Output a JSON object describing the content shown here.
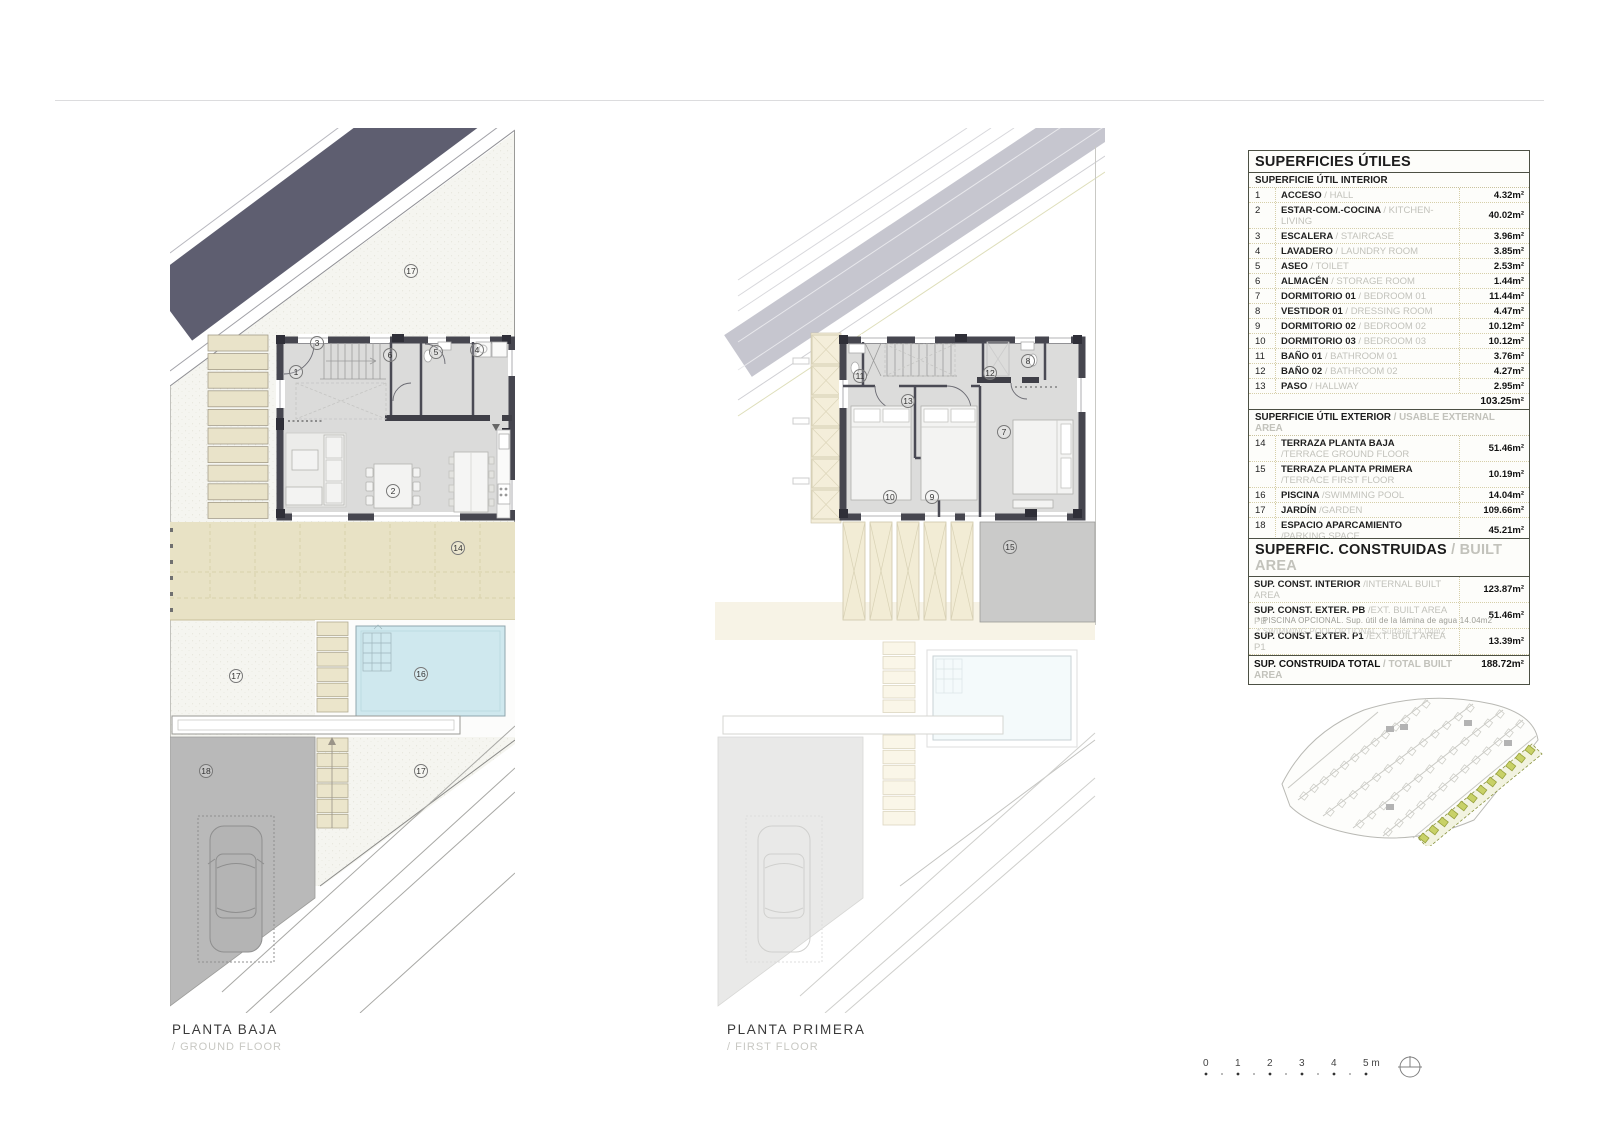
{
  "captions": {
    "floor1": "PLANTA BAJA",
    "floor1_sub": "/ GROUND FLOOR",
    "floor2": "PLANTA PRIMERA",
    "floor2_sub": "/ FIRST FLOOR"
  },
  "tables": {
    "utiles": {
      "title": "SUPERFICIES ÚTILES",
      "interior_header": "SUPERFICIE ÚTIL INTERIOR",
      "interior_rows": [
        {
          "num": "1",
          "es": "ACCESO",
          "en": "/ HALL",
          "val": "4.32m²"
        },
        {
          "num": "2",
          "es": "ESTAR-COM.-COCINA",
          "en": "/ KITCHEN-LIVING",
          "val": "40.02m²"
        },
        {
          "num": "3",
          "es": "ESCALERA",
          "en": "/ STAIRCASE",
          "val": "3.96m²"
        },
        {
          "num": "4",
          "es": "LAVADERO",
          "en": "/ LAUNDRY ROOM",
          "val": "3.85m²"
        },
        {
          "num": "5",
          "es": "ASEO",
          "en": "/ TOILET",
          "val": "2.53m²"
        },
        {
          "num": "6",
          "es": "ALMACÉN",
          "en": "/ STORAGE ROOM",
          "val": "1.44m²"
        },
        {
          "num": "7",
          "es": "DORMITORIO 01",
          "en": "/ BEDROOM 01",
          "val": "11.44m²"
        },
        {
          "num": "8",
          "es": "VESTIDOR 01",
          "en": "/ DRESSING ROOM",
          "val": "4.47m²"
        },
        {
          "num": "9",
          "es": "DORMITORIO 02",
          "en": "/ BEDROOM 02",
          "val": "10.12m²"
        },
        {
          "num": "10",
          "es": "DORMITORIO 03",
          "en": "/ BEDROOM 03",
          "val": "10.12m²"
        },
        {
          "num": "11",
          "es": "BAÑO 01",
          "en": "/ BATHROOM 01",
          "val": "3.76m²"
        },
        {
          "num": "12",
          "es": "BAÑO 02",
          "en": "/ BATHROOM 02",
          "val": "4.27m²"
        },
        {
          "num": "13",
          "es": "PASO",
          "en": "/ HALLWAY",
          "val": "2.95m²"
        }
      ],
      "interior_subtotal": "103.25m²",
      "exterior_header_es": "SUPERFICIE ÚTIL EXTERIOR",
      "exterior_header_en": "/ USABLE EXTERNAL AREA",
      "exterior_rows": [
        {
          "num": "14",
          "es": "TERRAZA PLANTA BAJA",
          "en": "/TERRACE GROUND FLOOR",
          "val": "51.46m²",
          "two": true
        },
        {
          "num": "15",
          "es": "TERRAZA PLANTA PRIMERA",
          "en": "/TERRACE FIRST FLOOR",
          "val": "10.19m²",
          "two": true
        },
        {
          "num": "16",
          "es": "PISCINA",
          "en": "/SWIMMING POOL",
          "val": "14.04m²"
        },
        {
          "num": "17",
          "es": "JARDÍN",
          "en": "/GARDEN",
          "val": "109.66m²"
        },
        {
          "num": "18",
          "es": "ESPACIO APARCAMIENTO",
          "en": "/PARKING SPACE",
          "val": "45.21m²",
          "two": true
        }
      ],
      "exterior_subtotal": "230.56m²",
      "total_es": "SUPERFICIE ÚTIL TOTAL",
      "total_en": "/ TOTAL USABLE AREA",
      "total_val": "333.81m²"
    },
    "construidas": {
      "title_es": "SUPERFIC. CONSTRUIDAS",
      "title_en": "/ BUILT AREA",
      "rows": [
        {
          "es": "SUP. CONST. INTERIOR",
          "en": "/INTERNAL BUILT AREA",
          "val": "123.87m²"
        },
        {
          "es": "SUP. CONST. EXTER. PB",
          "en": "/EXT. BUILT AREA PB",
          "val": "51.46m²"
        },
        {
          "es": "SUP. CONST. EXTER. P1",
          "en": "/EXT. BUILT AREA P1",
          "val": "13.39m²"
        }
      ],
      "total_es": "SUP. CONSTRUIDA TOTAL",
      "total_en": "/ TOTAL BUILT AREA",
      "total_val": "188.72m²",
      "footnote_es": "* PISCINA OPCIONAL. Sup. útil de la lámina de agua 14.04m2",
      "footnote_en": "* SWIMMING POOL OPTIONAL. Surface 14.04m2"
    }
  },
  "plans": {
    "ground": {
      "labels": {
        "r1": "1",
        "r2": "2",
        "r3": "3",
        "r4": "4",
        "r5": "5",
        "r6": "6",
        "g17top": "17",
        "t14": "14",
        "g17mid": "17",
        "p16": "16",
        "s18": "18",
        "g17bot": "17"
      }
    },
    "first": {
      "labels": {
        "r7": "7",
        "r8": "8",
        "r9": "9",
        "r10": "10",
        "r11": "11",
        "r12": "12",
        "r13": "13",
        "t15": "15"
      }
    }
  },
  "scalebar": {
    "ticks": [
      "0",
      "1",
      "2",
      "3",
      "4",
      "5 m"
    ]
  },
  "colors": {
    "band": "#5e5e70",
    "band_faded": "#c6c6cf",
    "beige": "#e8e2c5",
    "slat": "#e9e3c9",
    "pool": "#cfe8ee",
    "parking": "#b9b9b9",
    "wall": "#46464f",
    "floor": "#dbdbda",
    "table_border": "#4c5044",
    "dotted": "#d6cfa9",
    "highlight_green": "#c8d167"
  }
}
